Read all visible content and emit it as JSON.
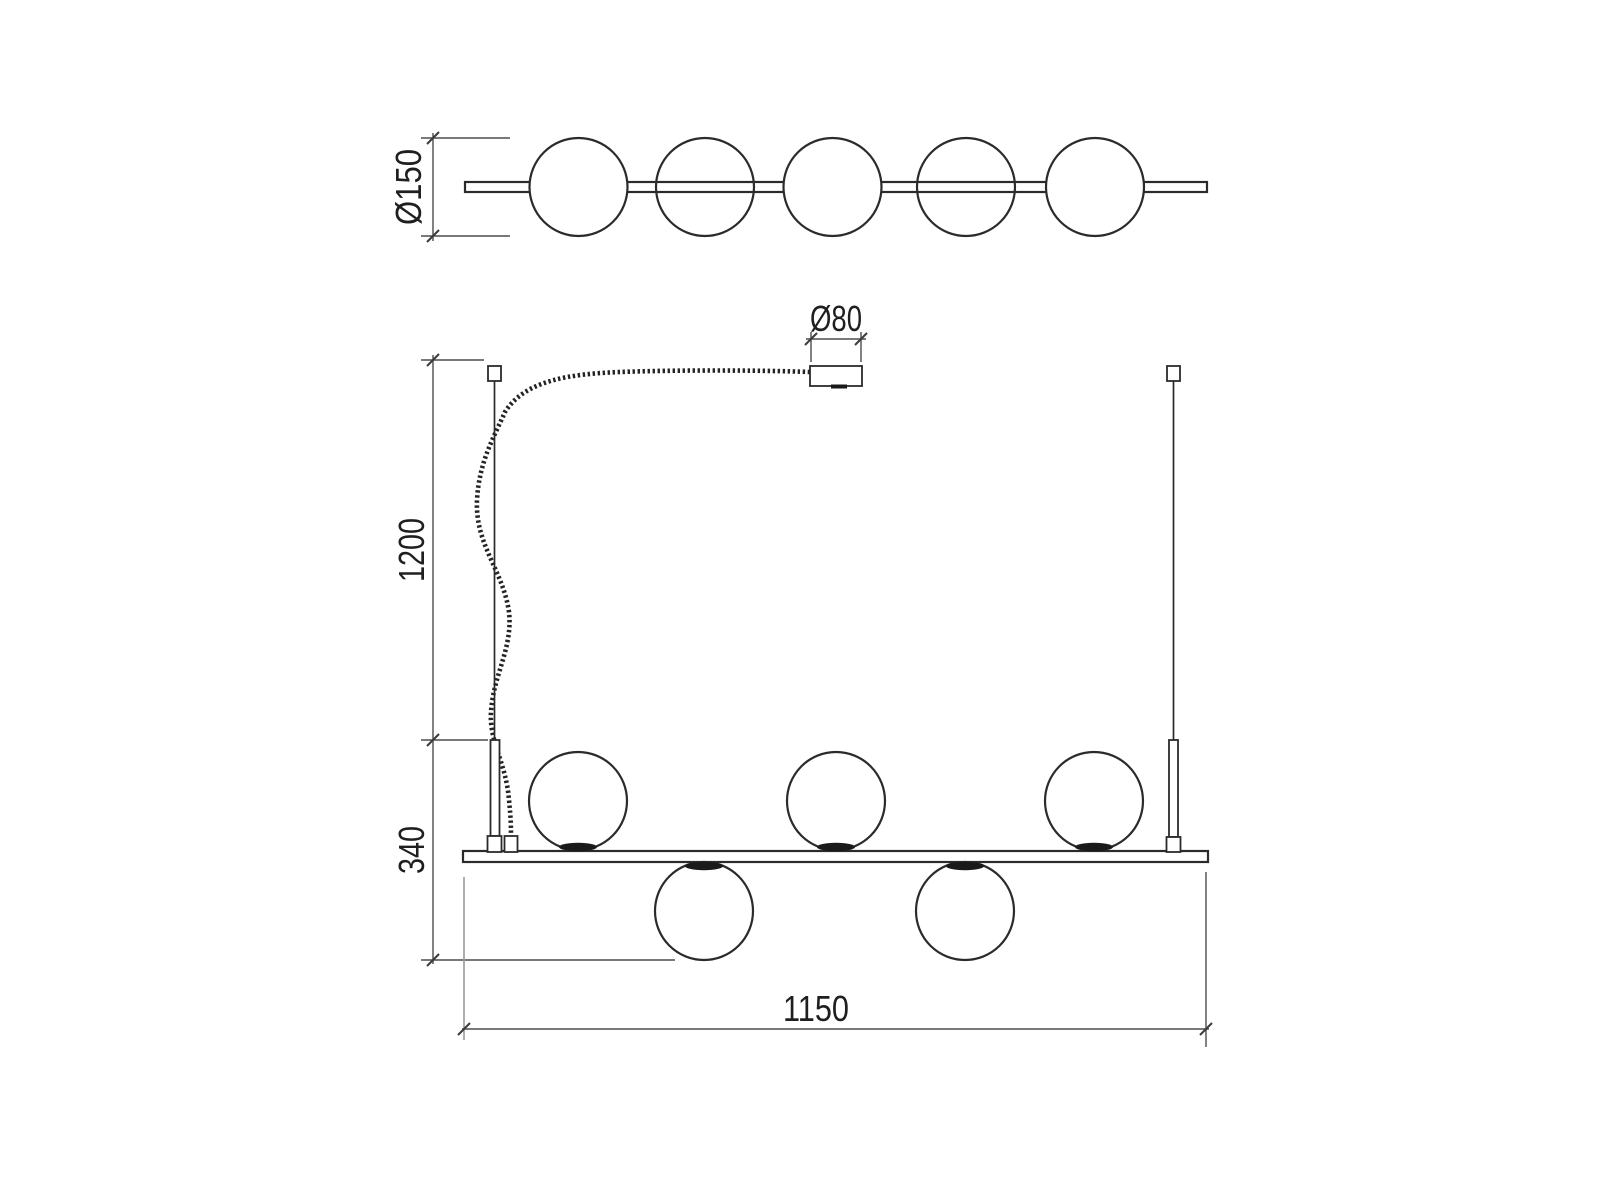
{
  "colors": {
    "background": "#ffffff",
    "outline": "#2b2b2b",
    "dimension_line": "#4d4d4d",
    "light_extension_line": "#9b9b9b",
    "contact_pad": "#1a1a1a",
    "text": "#1f1f1f"
  },
  "top_view": {
    "globe_count": 5,
    "dim_diameter": {
      "label": "Ø150"
    }
  },
  "front_view": {
    "globes_above_bar": 3,
    "globes_below_bar": 2,
    "suspension_count": 2,
    "dim_canopy_diameter": {
      "label": "Ø80"
    },
    "dim_suspension_length": {
      "label": "1200"
    },
    "dim_body_height": {
      "label": "340"
    },
    "dim_bar_length": {
      "label": "1150"
    }
  }
}
